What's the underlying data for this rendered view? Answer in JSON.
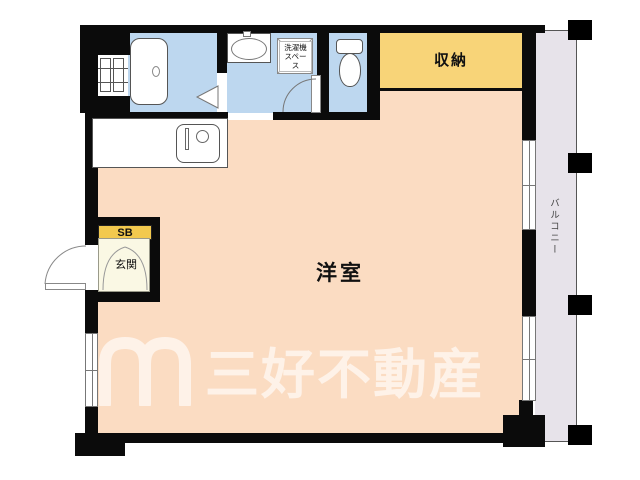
{
  "floorplan": {
    "rooms": {
      "main_room": {
        "label": "洋室",
        "color": "#fbdcc2"
      },
      "storage": {
        "label": "収納",
        "color": "#f8d478"
      },
      "entrance": {
        "label": "玄関",
        "color": "#faf8e4"
      },
      "shoe_box": {
        "label": "SB",
        "color": "#f2c94e"
      },
      "balcony": {
        "label": "バルコニー",
        "color": "#e7e3ea"
      },
      "washer_space": {
        "label_line1": "洗濯機",
        "label_line2": "スペース"
      },
      "wet_area_color": "#bdd7ef",
      "wall_color": "#0b0b0b"
    },
    "watermark": {
      "company": "三好不動産"
    }
  }
}
